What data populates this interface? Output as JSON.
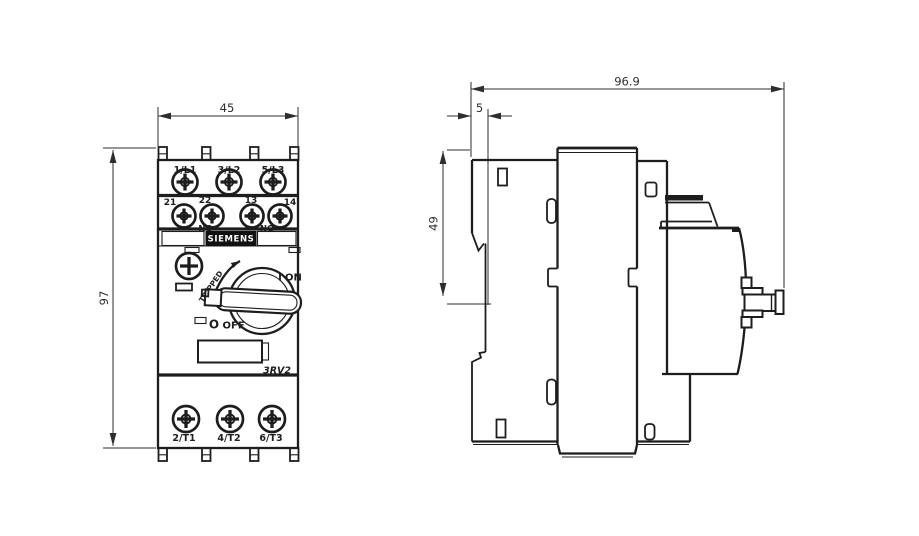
{
  "colors": {
    "line": "#1d1d1d",
    "background": "#ffffff",
    "brand_bg": "#111111",
    "brand_text": "#ffffff"
  },
  "front_view": {
    "width_dim": "45",
    "height_dim": "97",
    "line_terminals": [
      "1/L1",
      "3/L2",
      "5/L3"
    ],
    "load_terminals": [
      "2/T1",
      "4/T2",
      "6/T3"
    ],
    "aux": {
      "nc_left": "21",
      "nc_right": "22",
      "nc_label": "NC",
      "no_left": "13",
      "no_right": "14",
      "no_label": "NO"
    },
    "brand": "SIEMENS",
    "model": "3RV2",
    "switch": {
      "on_symbol": "I",
      "on_label": "ON",
      "off_symbol": "O",
      "off_label": "OFF",
      "tripped_label": "TRIPPED"
    }
  },
  "side_view": {
    "overall_depth_dim": "96.9",
    "clip_depth_dim": "5",
    "rail_height_dim": "49"
  }
}
